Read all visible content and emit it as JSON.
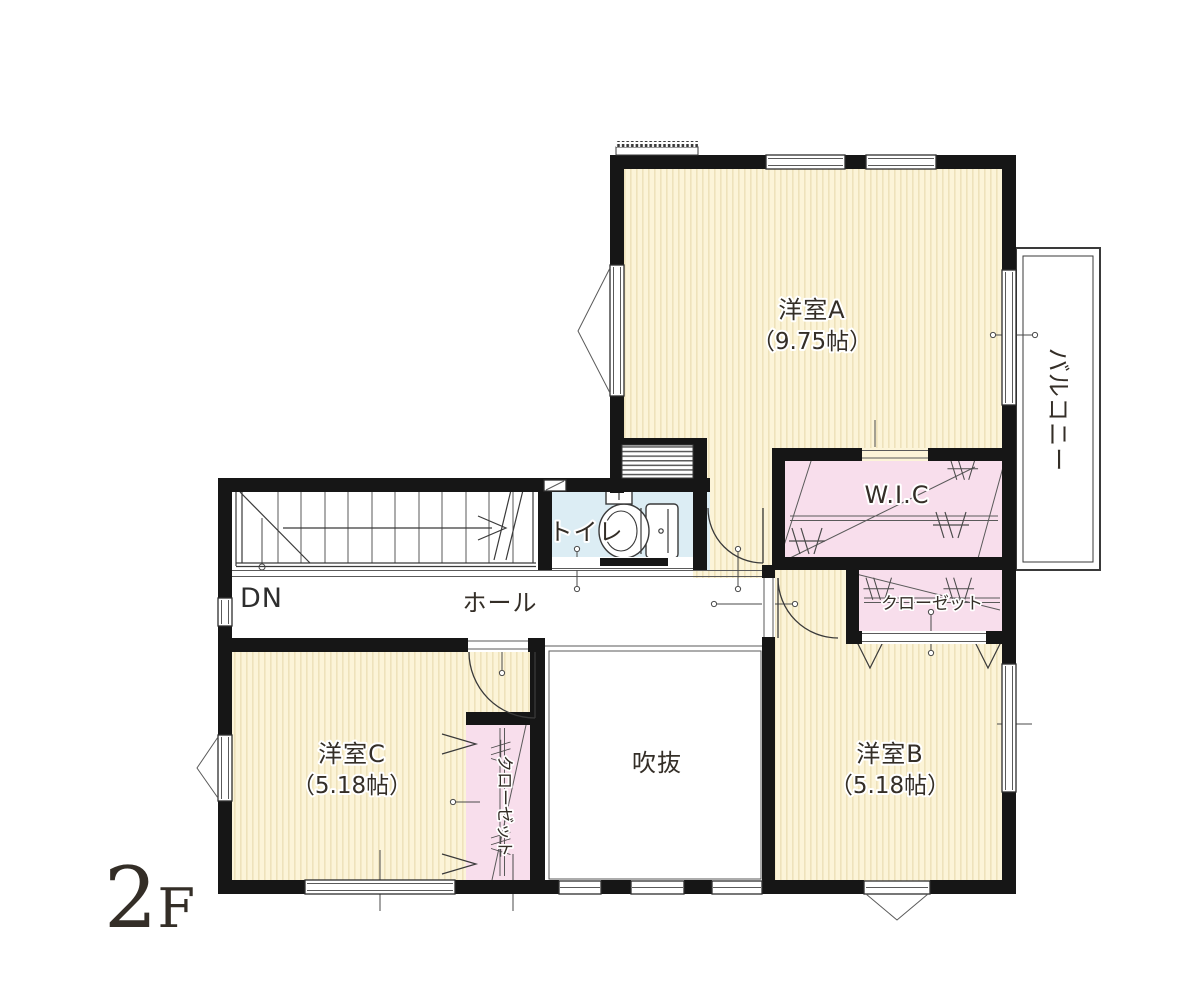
{
  "floor_label": {
    "big": "2",
    "small": "F"
  },
  "colors": {
    "wall": "#161616",
    "room_cream": "#fcf4d8",
    "room_cream_stripe": "#eee2bb",
    "room_pink": "#f8deec",
    "room_blue": "#dcedf4",
    "floor_label_gray": "#a9b1bb"
  },
  "rooms": {
    "yoshitsu_a": {
      "name": "洋室A",
      "size": "（9.75帖）"
    },
    "yoshitsu_b": {
      "name": "洋室B",
      "size": "（5.18帖）"
    },
    "yoshitsu_c": {
      "name": "洋室C",
      "size": "（5.18帖）"
    },
    "wic": {
      "name": "W.I.C"
    },
    "closet_right": {
      "name": "クローゼット"
    },
    "closet_left": {
      "name": "クローゼット"
    },
    "toilet": {
      "name": "トイレ"
    },
    "hall": {
      "name": "ホール"
    },
    "void": {
      "name": "吹抜"
    },
    "balcony": {
      "name": "バルコニー"
    },
    "stairs": {
      "label": "DN"
    }
  }
}
